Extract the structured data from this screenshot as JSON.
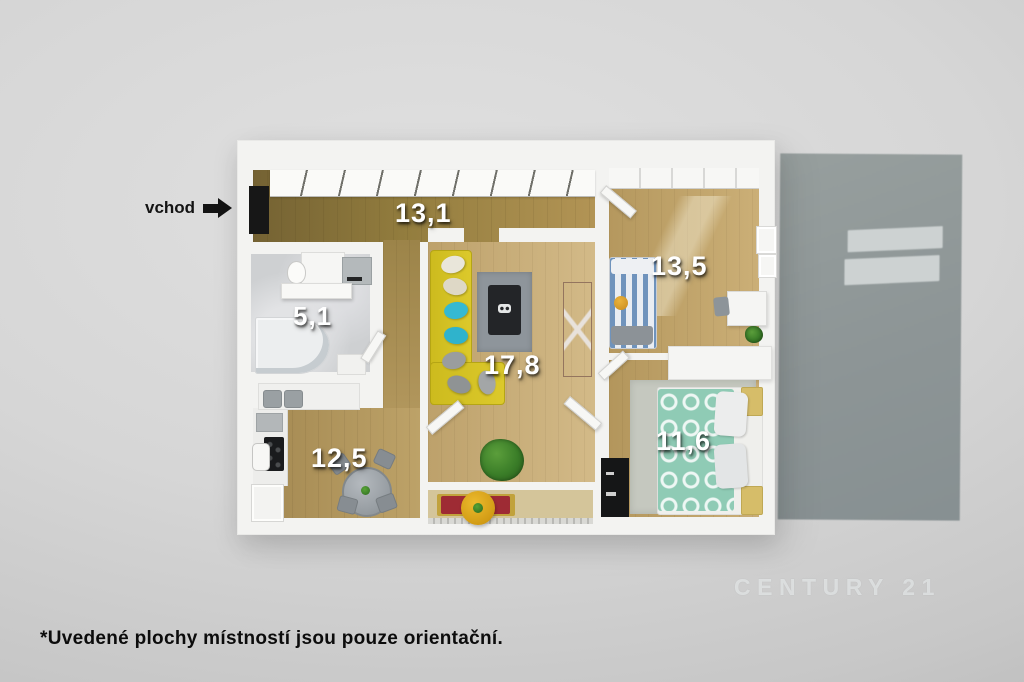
{
  "scene": {
    "type": "3d-floorplan-render",
    "entrance_label": "vchod",
    "disclaimer": "*Uvedené plochy místností jsou pouze orientační.",
    "watermark": "CENTURY 21"
  },
  "rooms": [
    {
      "name": "hallway",
      "area_label": "13,1"
    },
    {
      "name": "bathroom",
      "area_label": "5,1"
    },
    {
      "name": "kitchen",
      "area_label": "12,5"
    },
    {
      "name": "living-room",
      "area_label": "17,8"
    },
    {
      "name": "bedroom-upper",
      "area_label": "13,5"
    },
    {
      "name": "bedroom-lower",
      "area_label": "11,6"
    }
  ],
  "palette": {
    "background": "#d2d2d2",
    "wall_white": "#f3f3f1",
    "wood_dark": "#937d3e",
    "wood_light": "#c9ae7d",
    "bathroom_marble": "#ced0d2",
    "sofa_yellow": "#d5c31f",
    "pillow_teal": "#35b9d2",
    "bed_stripe_blue": "#6f93bc",
    "bed_duvet_teal": "#8fcbb5",
    "bench_red": "#9e2b34",
    "balcony_table_yellow": "#d29c15",
    "shadow_panel": "#8d9596",
    "label_text": "#ffffff"
  }
}
